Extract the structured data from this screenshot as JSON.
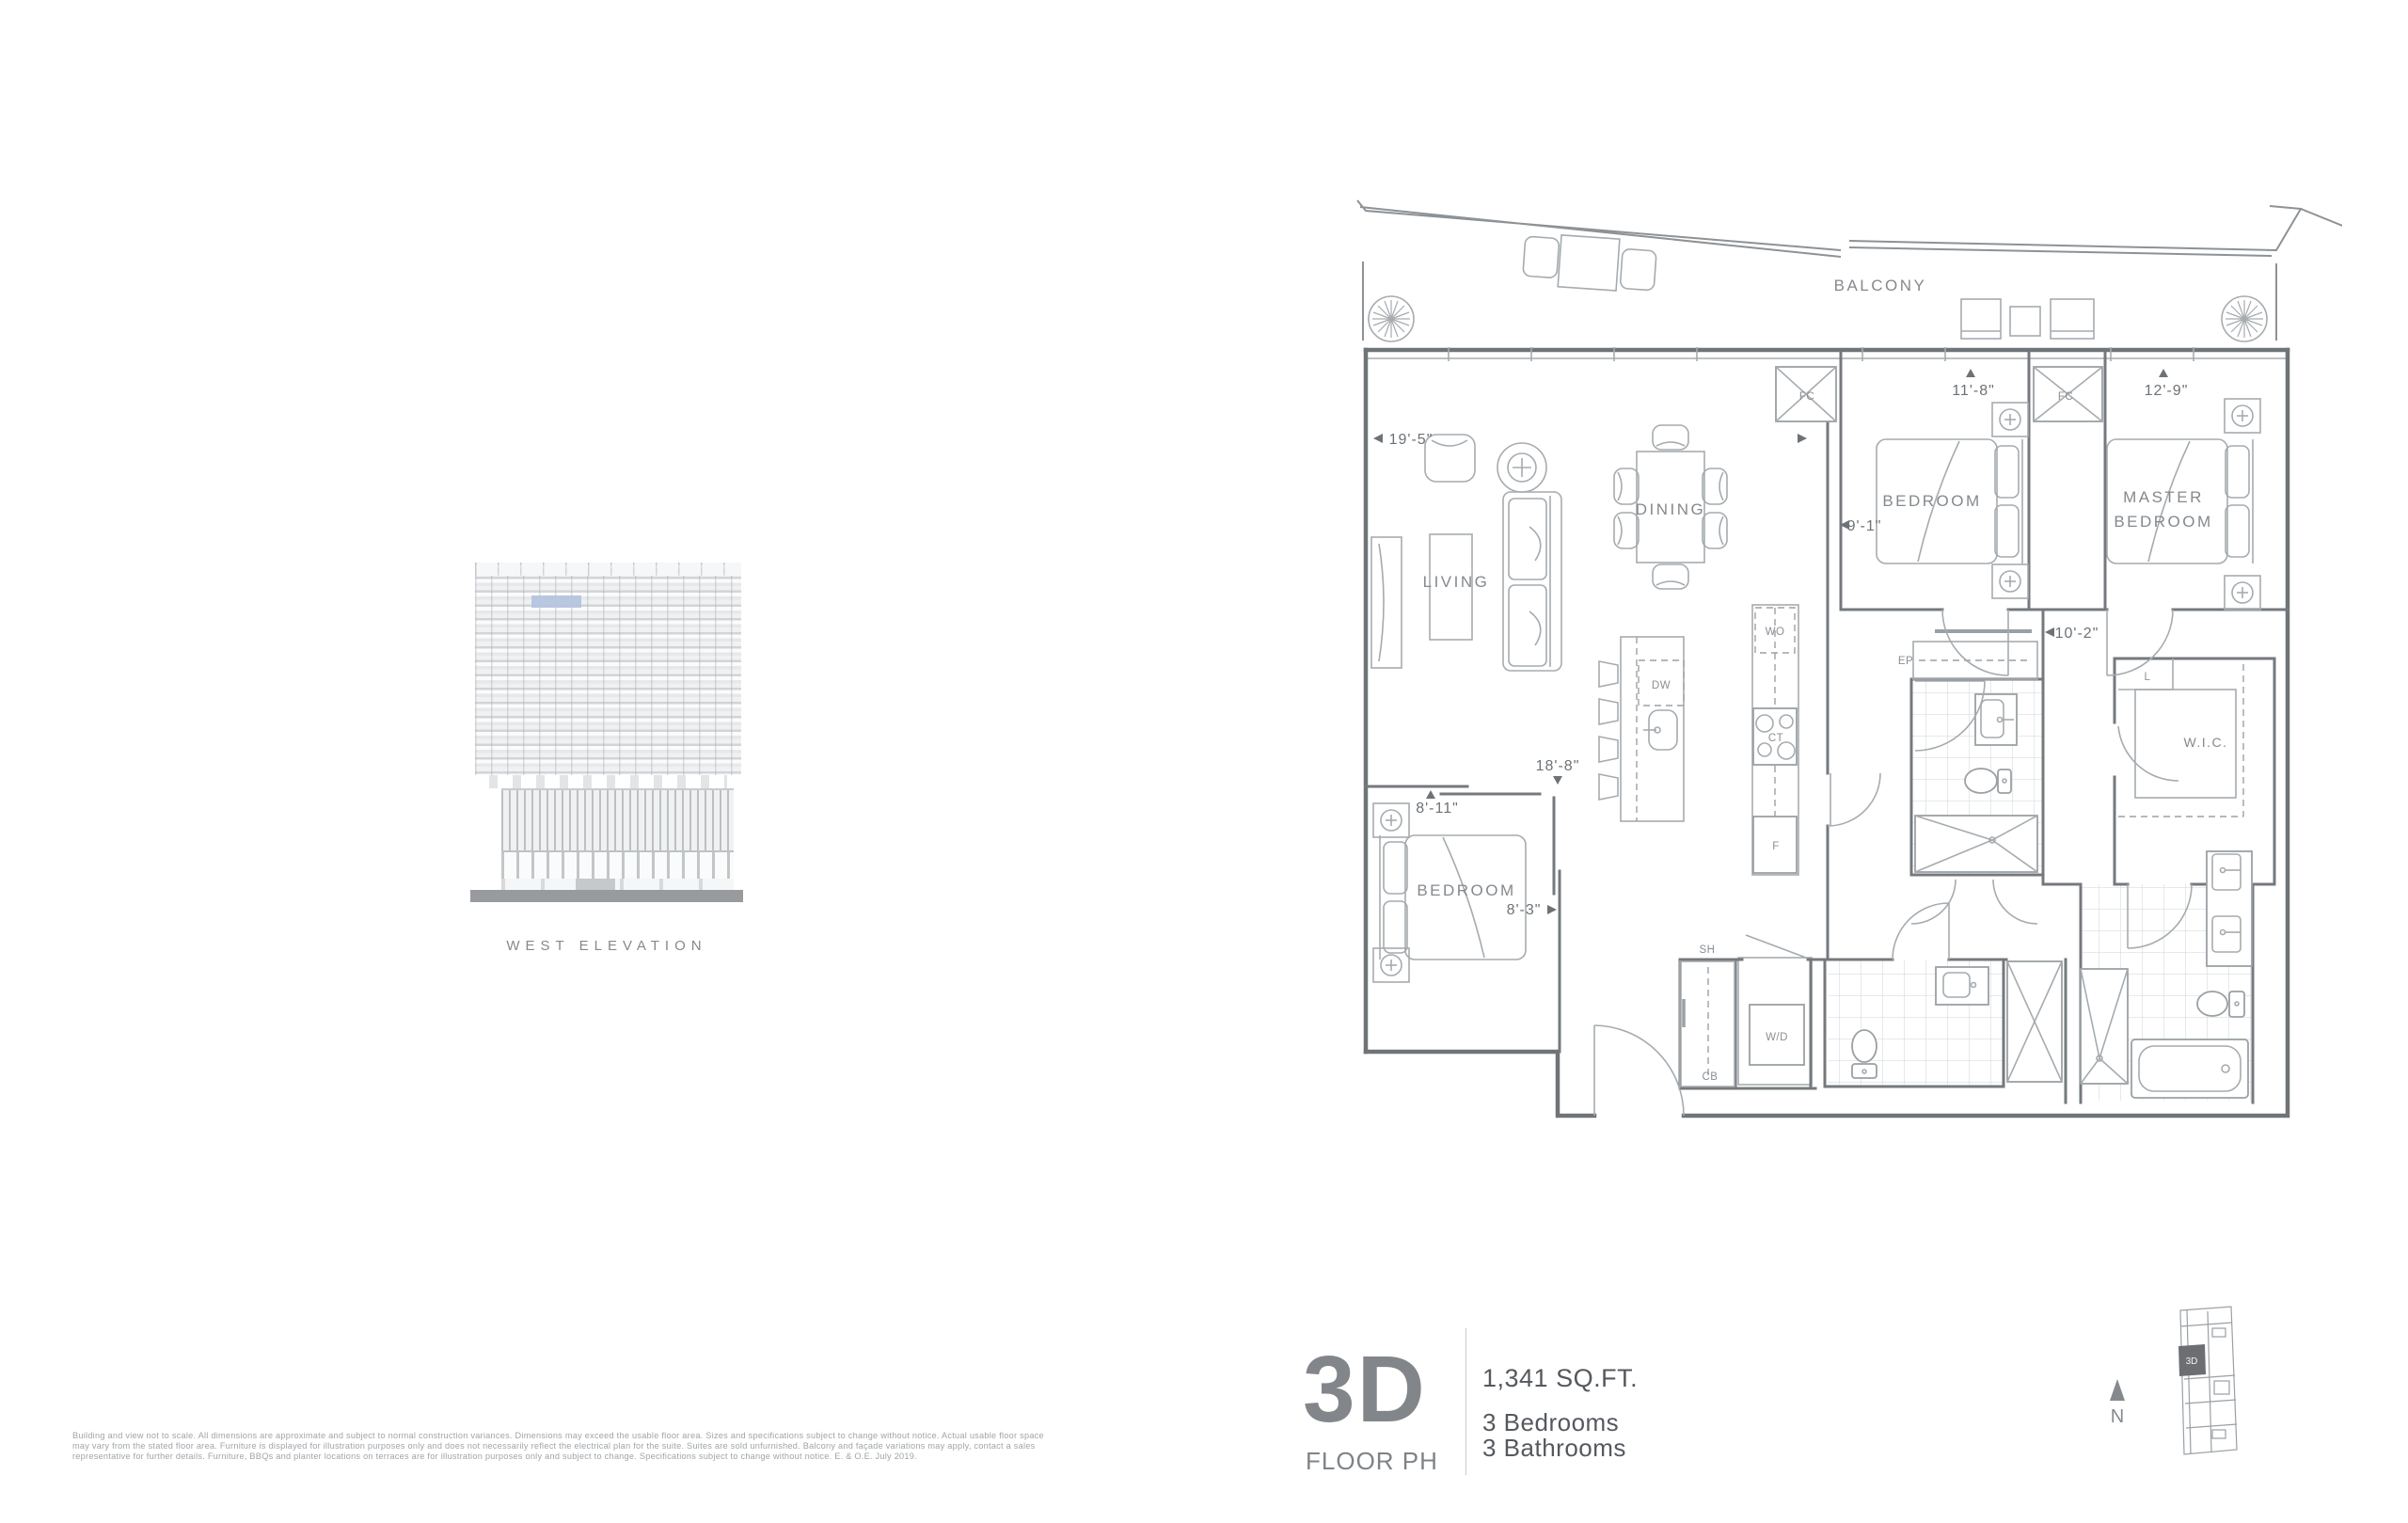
{
  "elevation": {
    "caption": "WEST ELEVATION",
    "highlight_color": "#b4c3de"
  },
  "plan": {
    "rooms": {
      "balcony": "BALCONY",
      "living": "LIVING",
      "dining": "DINING",
      "bedroom_top": "BEDROOM",
      "master_line1": "MASTER",
      "master_line2": "BEDROOM",
      "bedroom_bottom": "BEDROOM",
      "wic": "W.I.C."
    },
    "dims": {
      "living_w": "19'-5\"",
      "living_l": "18'-8\"",
      "bed2_w": "11'-8\"",
      "bed2_d": "9'-1\"",
      "master_w": "12'-9\"",
      "master_d": "10'-2\"",
      "bed3_w": "8'-11\"",
      "bed3_d": "8'-3\""
    },
    "tags": {
      "fc1": "FC",
      "fc2": "FC",
      "wo": "WO",
      "dw": "DW",
      "ct": "CT",
      "f": "F",
      "ep": "EP",
      "l": "L",
      "sh": "SH",
      "wd": "W/D",
      "cb": "CB"
    }
  },
  "info": {
    "unit": "3D",
    "floor": "FLOOR PH",
    "area": "1,341 SQ.FT.",
    "bedrooms": "3 Bedrooms",
    "bathrooms": "3 Bathrooms",
    "north": "N",
    "keyplan_unit": "3D",
    "keyplan_fill": "#6d6e71"
  },
  "disclaimer": {
    "line1": "Building and view not to scale. All dimensions are approximate and subject to normal construction variances. Dimensions may exceed the usable floor area. Sizes and specifications subject to change without notice. Actual usable floor space",
    "line2": "may vary from the stated floor area. Furniture is displayed for illustration purposes only and does not necessarily reflect the electrical plan for the suite. Suites are sold unfurnished. Balcony and façade variations may apply, contact a sales",
    "line3": "representative for further details. Furniture, BBQs and planter locations on terraces are for illustration purposes only and subject to change. Specifications subject to change without notice. E. & O.E. July 2019."
  }
}
